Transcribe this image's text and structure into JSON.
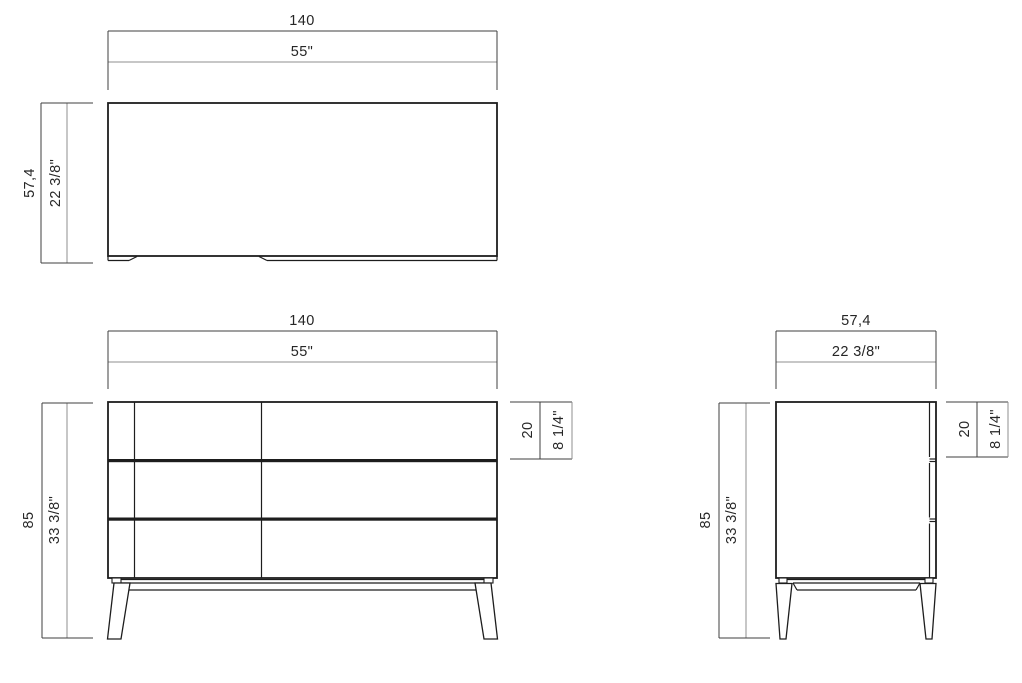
{
  "colors": {
    "background": "#ffffff",
    "ink": "#1d1d1d",
    "dim_primary": "#3f3f3f",
    "dim_secondary": "#8f8f8f",
    "text": "#262626"
  },
  "views": {
    "top": {
      "width_cm": "140",
      "width_in": "55\"",
      "depth_cm": "57,4",
      "depth_in": "22 3/8\""
    },
    "front": {
      "width_cm": "140",
      "width_in": "55\"",
      "height_cm": "85",
      "height_in": "33 3/8\"",
      "drawer_cm": "20",
      "drawer_in": "8 1/4\""
    },
    "side": {
      "depth_cm": "57,4",
      "depth_in": "22 3/8\"",
      "height_cm": "85",
      "height_in": "33 3/8\"",
      "drawer_cm": "20",
      "drawer_in": "8 1/4\""
    }
  }
}
